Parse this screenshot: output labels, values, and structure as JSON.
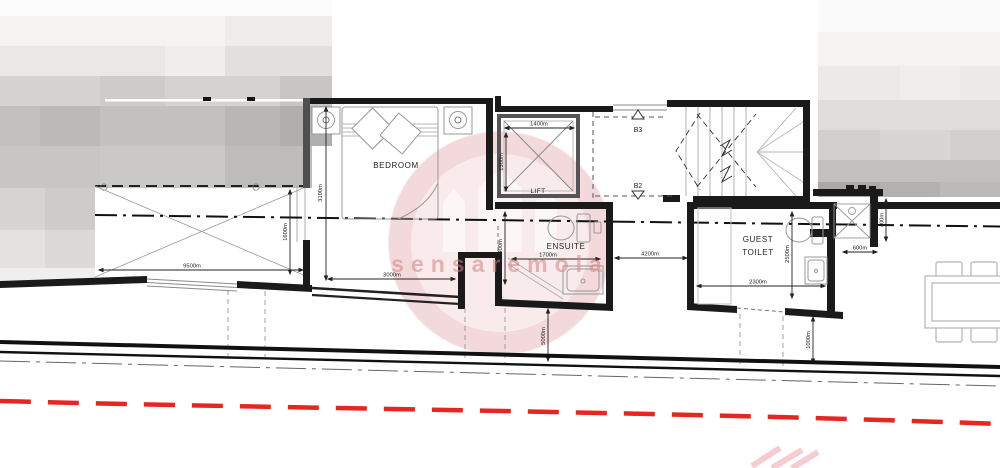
{
  "plan": {
    "rooms": {
      "bedroom": "BEDROOM",
      "lift": "LIFT",
      "ensuite": "ENSUITE",
      "guest_toilet_line1": "GUEST",
      "guest_toilet_line2": "TOILET"
    },
    "markers": {
      "b3": "B3",
      "b2": "B2"
    },
    "dims": {
      "bedroom_height": "3100m",
      "void_height": "1600m",
      "void_width": "9500m",
      "bedroom_width": "3000m",
      "lift_width": "1400m",
      "lift_depth": "1300m",
      "ensuite_depth": "1400m",
      "ensuite_width": "1700m",
      "corridor_width": "4200m",
      "guest_toilet_width": "2300m",
      "guest_toilet_depth": "2500m",
      "shaft_width": "600m",
      "shaft_depth": "400m",
      "terrace_left": "5000m",
      "terrace_right": "1000m"
    }
  },
  "watermark": {
    "text": "sensaremola"
  },
  "colors": {
    "wall": "#1a1a1a",
    "dim_line": "#333333",
    "fixture": "#9a9a9a",
    "red_boundary": "#e8251f",
    "watermark_pink": "#c23a4a"
  }
}
